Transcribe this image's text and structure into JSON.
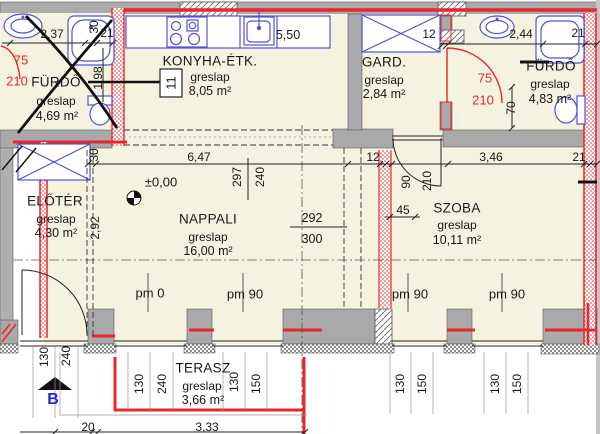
{
  "title": "Lakás alaprajz (floor plan)",
  "colors": {
    "accent_red": "#e8262c",
    "fixture_blue": "#5252d6",
    "wall_gray": "#ababab",
    "floor_cream": "#f6f2e0",
    "section_blue": "#2424dc"
  },
  "rooms": [
    {
      "name": "FÜRDŐ",
      "floor": "greslap",
      "area": "4,69 m²"
    },
    {
      "name": "KONYHA-ÉTK.",
      "floor": "greslap",
      "area": "8,05 m²"
    },
    {
      "name": "GARD.",
      "floor": "greslap",
      "area": "2,84 m²"
    },
    {
      "name": "FÜRDŐ",
      "floor": "greslap",
      "area": "4,83 m²"
    },
    {
      "name": "ELŐTÉR",
      "floor": "greslap",
      "area": "4,30 m²"
    },
    {
      "name": "NAPPALI",
      "floor": "greslap",
      "area": "16,00 m²"
    },
    {
      "name": "SZOBA",
      "floor": "greslap",
      "area": "10,11 m²"
    },
    {
      "name": "TERASZ",
      "floor": "greslap",
      "area": "3,66 m²"
    }
  ],
  "dims": {
    "bath1": {
      "width": "2,37",
      "wall": "30",
      "jamb": "21",
      "depth": "1,98"
    },
    "door_bath1": {
      "w": "75",
      "h": "210"
    },
    "kitchen": {
      "counter": "5,50",
      "ref": "11"
    },
    "gard": {
      "wall": "12"
    },
    "bath2": {
      "width": "2,44",
      "jamb": "21",
      "sill": "70"
    },
    "door_bath2": {
      "w": "75",
      "h": "210"
    },
    "mid": {
      "wall": "30",
      "nappali_w": "6,47",
      "h1": "297",
      "h2": "240",
      "wall2": "12",
      "szoba_w": "3,46",
      "jamb": "21"
    },
    "nappali": {
      "level": "±0,00",
      "eloter_w": "2,92",
      "clear": "292",
      "total": "300"
    },
    "szoba_door": {
      "w": "90",
      "h": "210",
      "off": "45"
    },
    "parapet": [
      "pm 0",
      "pm 90",
      "pm 90",
      "pm 90"
    ],
    "left": {
      "a": "130",
      "b": "240"
    },
    "terrace_dims": {
      "a": "130",
      "b": "240",
      "c": "130",
      "d": "150"
    },
    "right1": {
      "a": "130",
      "b": "150"
    },
    "right2": {
      "a": "130",
      "b": "150"
    },
    "bottom": {
      "a": "20",
      "b": "3,33"
    },
    "section": "B"
  }
}
